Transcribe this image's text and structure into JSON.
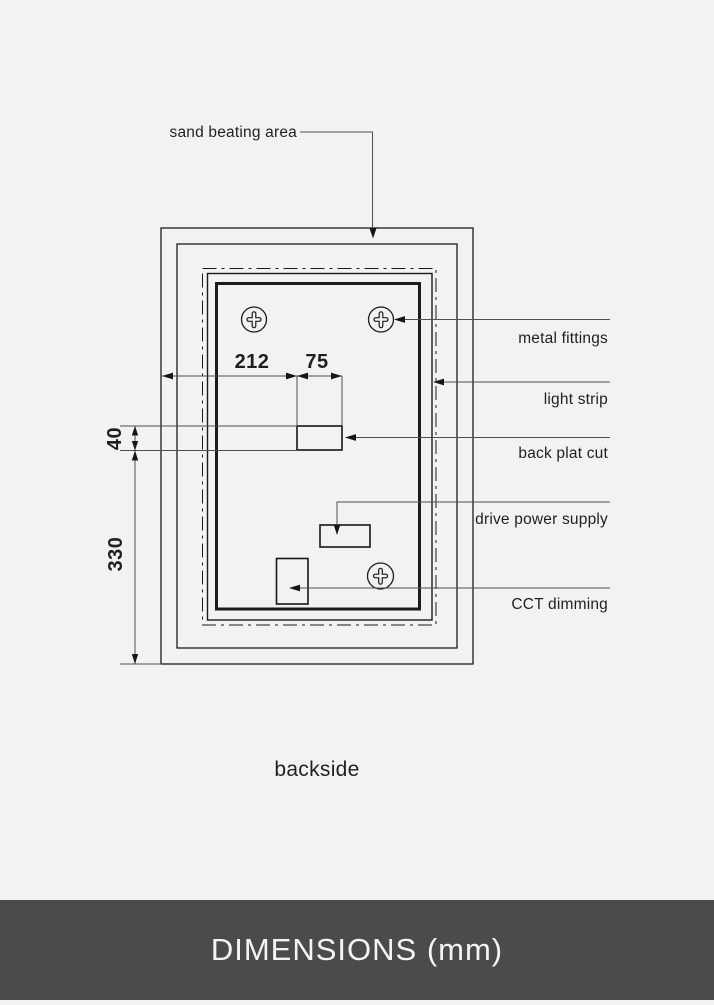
{
  "colors": {
    "background": "#f2f2f0",
    "drawing_line": "#1b1b1b",
    "leader_line": "#4f4f4f",
    "footer_background": "#4b4b4d",
    "footer_text": "#f4f4f4"
  },
  "diagram": {
    "callouts": {
      "sand_beating_area": "sand beating area",
      "metal_fittings": "metal fittings",
      "light_strip": "light strip",
      "back_plat_cut": "back plat cut",
      "drive_power_supply": "drive power supply",
      "cct_dimming": "CCT dimming"
    },
    "dimensions": {
      "width_to_cutout": "212",
      "cutout_width": "75",
      "cutout_height": "40",
      "bottom_offset": "330"
    },
    "caption": "backside"
  },
  "footer": {
    "title": "DIMENSIONS (mm)"
  }
}
